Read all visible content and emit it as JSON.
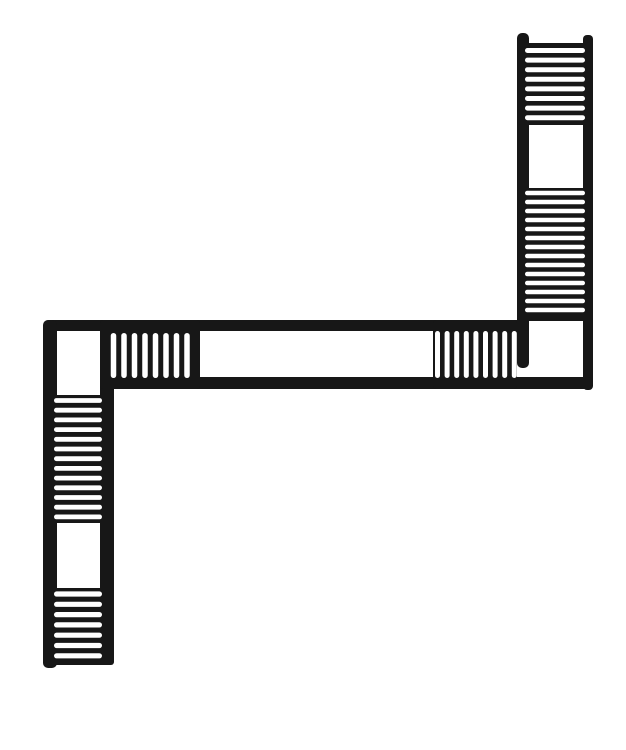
{
  "description": "Black-and-white line drawing: plan view of a switchback staircase — an S-shaped channel with hatched stair-tread sections and blank landings",
  "canvas": {
    "width": 626,
    "height": 750,
    "bg": "#ffffff",
    "ink": "#171717"
  },
  "drawing": {
    "bars": [
      {
        "name": "right-flight-left-rail",
        "x": 517,
        "y": 33,
        "w": 12,
        "h": 335,
        "rx": 5
      },
      {
        "name": "right-flight-right-rail",
        "x": 583,
        "y": 35,
        "w": 10,
        "h": 355,
        "rx": 4
      },
      {
        "name": "corridor-top-wall",
        "x": 45,
        "y": 320,
        "w": 484,
        "h": 11,
        "rx": 4
      },
      {
        "name": "corridor-bottom-wall",
        "x": 103,
        "y": 377,
        "w": 490,
        "h": 12,
        "rx": 5
      },
      {
        "name": "left-flight-left-rail",
        "x": 43,
        "y": 320,
        "w": 14,
        "h": 348,
        "rx": 5
      },
      {
        "name": "left-flight-right-rail",
        "x": 100,
        "y": 381,
        "w": 14,
        "h": 284,
        "rx": 5
      }
    ],
    "tread_blocks": [
      {
        "name": "right-flight-upper-treads",
        "x": 517,
        "y": 43,
        "w": 76,
        "h": 82,
        "slots": {
          "count": 8,
          "dir": "h",
          "from": 525,
          "to": 585,
          "start": 50.5,
          "step": 9.6,
          "thickness": 5.0
        }
      },
      {
        "name": "right-flight-lower-treads",
        "x": 517,
        "y": 188,
        "w": 76,
        "h": 133,
        "slots": {
          "count": 14,
          "dir": "h",
          "from": 525,
          "to": 585,
          "start": 193,
          "step": 9.0,
          "thickness": 4.6
        }
      },
      {
        "name": "corridor-left-treads",
        "x": 100,
        "y": 320,
        "w": 100,
        "h": 69,
        "slots": {
          "count": 8,
          "dir": "v",
          "from": 333,
          "to": 378,
          "start": 113.5,
          "step": 10.5,
          "thickness": 5.5
        }
      },
      {
        "name": "corridor-right-treads",
        "x": 433,
        "y": 320,
        "w": 84,
        "h": 69,
        "slots": {
          "count": 9,
          "dir": "v",
          "from": 331,
          "to": 378,
          "start": 437.5,
          "step": 9.6,
          "thickness": 5.0
        }
      },
      {
        "name": "left-flight-upper-treads",
        "x": 43,
        "y": 395,
        "w": 71,
        "h": 128,
        "slots": {
          "count": 13,
          "dir": "h",
          "from": 54,
          "to": 102,
          "start": 400.5,
          "step": 9.7,
          "thickness": 4.8
        }
      },
      {
        "name": "left-flight-lower-treads",
        "x": 43,
        "y": 588,
        "w": 71,
        "h": 77,
        "slots": {
          "count": 7,
          "dir": "h",
          "from": 54,
          "to": 102,
          "start": 594,
          "step": 10.3,
          "thickness": 5.2
        }
      }
    ],
    "landings": [
      {
        "name": "right-flight-landing",
        "x": 529,
        "y": 126,
        "w": 54,
        "h": 61,
        "r": 7
      },
      {
        "name": "right-corner-landing",
        "x": 530,
        "y": 322,
        "w": 53,
        "h": 55,
        "r": 9
      },
      {
        "name": "corridor-hall",
        "x": 202,
        "y": 331,
        "w": 231,
        "h": 46,
        "r": 8
      },
      {
        "name": "left-corner-landing",
        "x": 57,
        "y": 332,
        "w": 43,
        "h": 62,
        "r": 6
      },
      {
        "name": "left-flight-landing",
        "x": 57,
        "y": 523,
        "w": 43,
        "h": 65,
        "r": 7
      }
    ]
  }
}
